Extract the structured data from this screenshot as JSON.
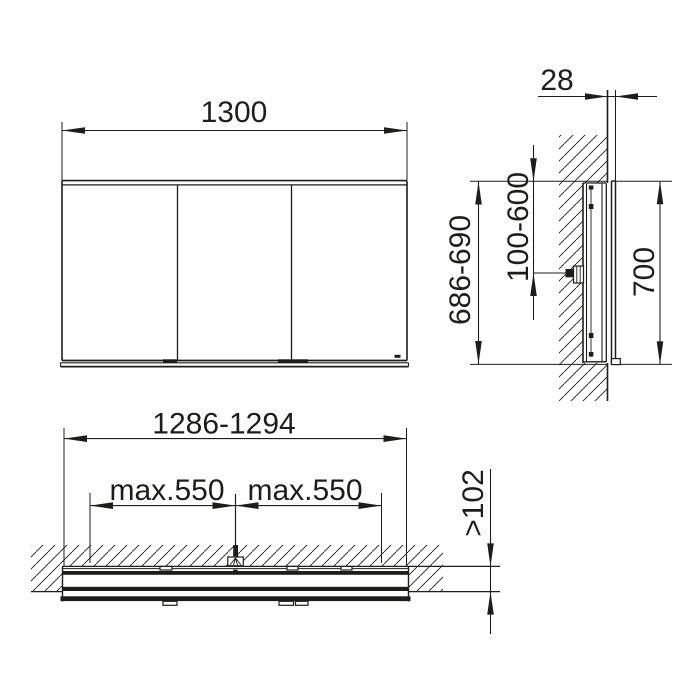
{
  "colors": {
    "line": "#1d1d1b",
    "background": "#ffffff"
  },
  "views": {
    "front": {
      "width_dim": "1300"
    },
    "side": {
      "protrusion_dim": "28",
      "niche_height_dim": "686-690",
      "mounting_range_dim": "100-600",
      "cabinet_height_dim": "700"
    },
    "plan": {
      "niche_width_dim": "1286-1294",
      "supply_left_dim": "max.550",
      "supply_right_dim": "max.550",
      "niche_depth_dim": ">102"
    }
  }
}
